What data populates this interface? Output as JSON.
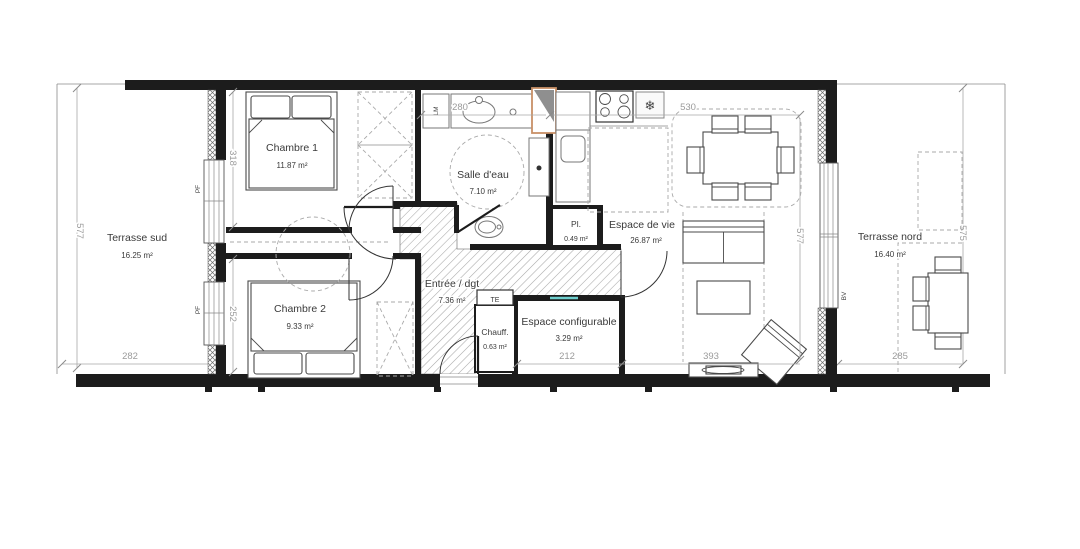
{
  "plan": {
    "rooms": [
      {
        "name": "Terrasse sud",
        "area": "16.25 m²"
      },
      {
        "name": "Chambre 1",
        "area": "11.87 m²"
      },
      {
        "name": "Chambre 2",
        "area": "9.33 m²"
      },
      {
        "name": "Salle d'eau",
        "area": "7.10 m²"
      },
      {
        "name": "Entrée / dgt",
        "area": "7.36 m²"
      },
      {
        "name": "Pl.",
        "area": "0.49 m²"
      },
      {
        "name": "Chauff.",
        "area": "0.63 m²"
      },
      {
        "name": "Espace de vie",
        "area": "26.87 m²"
      },
      {
        "name": "Espace configurable",
        "area": "3.29 m²"
      },
      {
        "name": "Terrasse nord",
        "area": "16.40 m²"
      }
    ],
    "dimensions": [
      {
        "id": "terrasse-sud-height",
        "value": "577"
      },
      {
        "id": "terrasse-sud-width",
        "value": "282"
      },
      {
        "id": "chambre-1-height",
        "value": "318"
      },
      {
        "id": "chambre-2-height",
        "value": "252"
      },
      {
        "id": "salle-eau-width",
        "value": "280"
      },
      {
        "id": "espace-vie-width",
        "value": "530"
      },
      {
        "id": "espace-vie-height",
        "value": "577"
      },
      {
        "id": "sejour-width",
        "value": "393"
      },
      {
        "id": "espace-configurable-width",
        "value": "212"
      },
      {
        "id": "terrasse-nord-width",
        "value": "285"
      },
      {
        "id": "terrasse-nord-height",
        "value": "575"
      }
    ],
    "annotations": [
      {
        "id": "porte-fenetre-1",
        "label": "PF"
      },
      {
        "id": "porte-fenetre-2",
        "label": "PF"
      },
      {
        "id": "baie-vitree",
        "label": "BV"
      },
      {
        "id": "lave-linge",
        "label": "LM"
      },
      {
        "id": "tableau-electrique",
        "label": "TE"
      }
    ],
    "icons": {
      "fridge": "❄"
    },
    "colors": {
      "wall": "#1c1c1c",
      "dimension": "#9b9b9b",
      "duct": "#c89067",
      "accent_teal": "#6fcfce",
      "hatch": "#a8a8a8"
    }
  }
}
